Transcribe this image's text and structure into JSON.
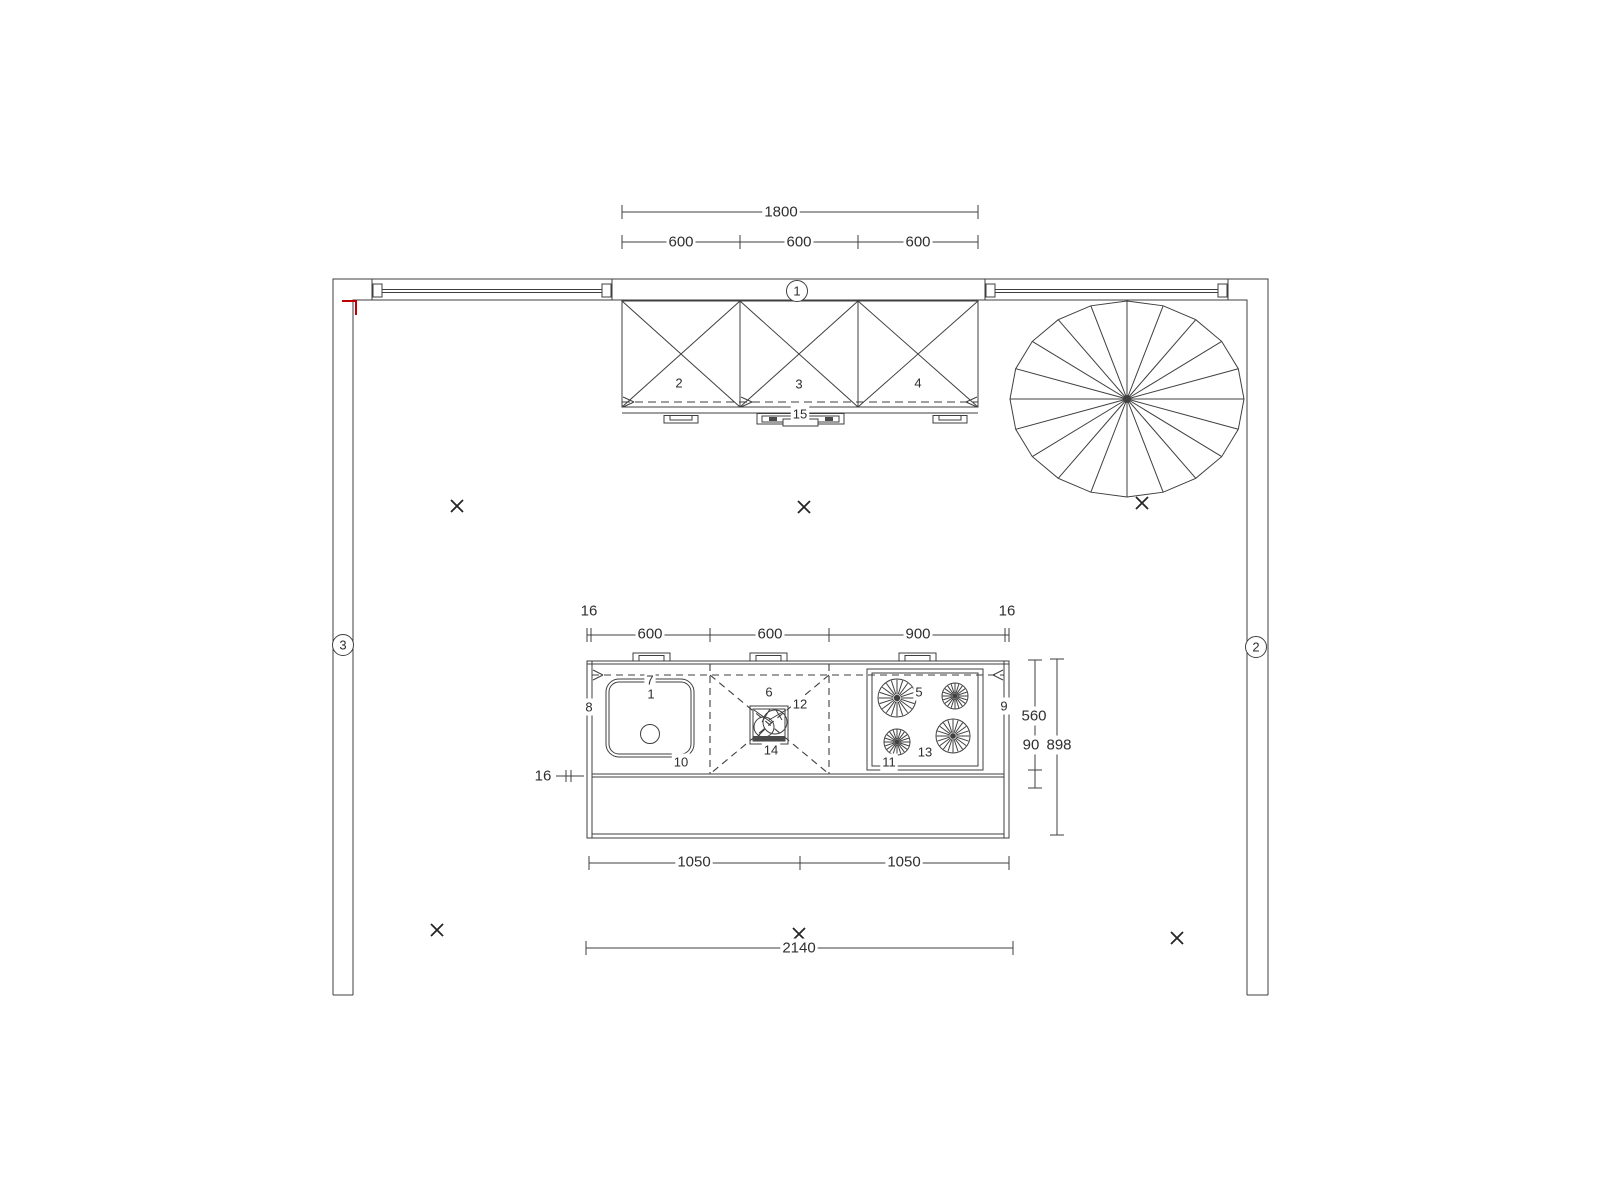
{
  "colors": {
    "background": "#ffffff",
    "line": "#3f3f3f",
    "accent_red": "#c00000",
    "text": "#2e2e2e"
  },
  "wall_markers": {
    "top": "1",
    "right": "2",
    "left": "3"
  },
  "dimensions": {
    "wall_cabinets_total": "1800",
    "wall_cabinet_widths": [
      "600",
      "600",
      "600"
    ],
    "island_offset_left": "16",
    "island_offset_right": "16",
    "island_top_widths": [
      "600",
      "600",
      "900"
    ],
    "island_depth_front": "560",
    "island_depth_overhang": "90",
    "island_depth_total": "898",
    "island_worktop_thickness": "16",
    "island_bottom_widths": [
      "1050",
      "1050"
    ],
    "island_total_width": "2140"
  },
  "items": {
    "sink_unit": "1",
    "wall_cabinet_left": "2",
    "wall_cabinet_mid": "3",
    "wall_cabinet_right": "4",
    "hob": "5",
    "mid_unit": "6",
    "worktop_back_edge": "7",
    "island_left_panel": "8",
    "island_right_panel": "9",
    "worktop_left": "10",
    "worktop_right": "11",
    "mid_unit_corner": "12",
    "hob_front": "13",
    "faucet": "14",
    "extractor_hood": "15"
  }
}
